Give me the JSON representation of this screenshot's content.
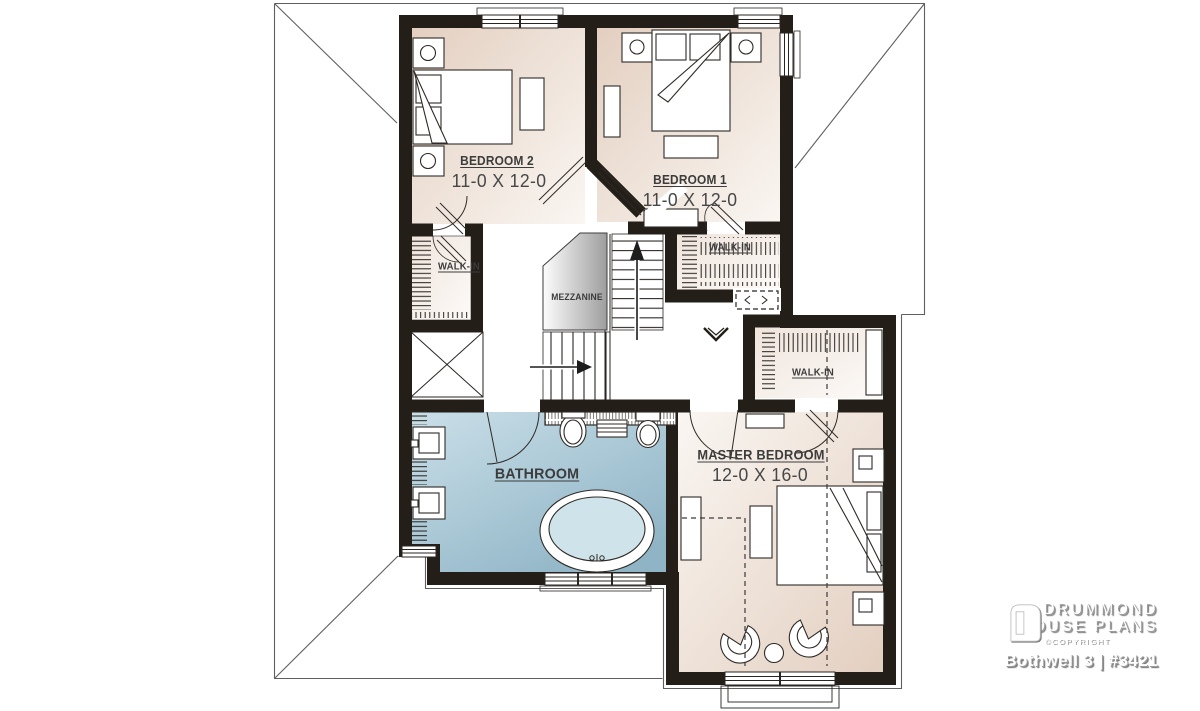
{
  "branding": {
    "name_line1": "DRUMMOND",
    "name_line2": "HOUSE PLANS",
    "copyright": "©COPYRIGHT",
    "plan_title": "Bothwell 3 | #3421",
    "logo_icon": "drummond-door-icon"
  },
  "rooms": {
    "bedroom2": {
      "name": "BEDROOM 2",
      "dims": "11-0 X 12-0"
    },
    "bedroom1": {
      "name": "BEDROOM 1",
      "dims": "11-0 X 12-0"
    },
    "walkin_bedroom2": {
      "name": "WALK-IN"
    },
    "walkin_bedroom1": {
      "name": "WALK-IN"
    },
    "walkin_master": {
      "name": "WALK-IN"
    },
    "mezzanine": {
      "name": "MEZZANINE"
    },
    "bathroom": {
      "name": "BATHROOM"
    },
    "master_bedroom": {
      "name": "MASTER BEDROOM",
      "dims": "12-0 X 16-0"
    }
  },
  "colors": {
    "wall": "#241e19",
    "room_beige_dark": "#e3cfc0",
    "room_beige_light": "#faf6f2",
    "bath_blue_dark": "#8fb4c6",
    "bath_blue_light": "#cadfe8",
    "mezzanine_dark": "#9e9e9e",
    "mezzanine_light": "#fdfdfd",
    "label_text": "#3c3c3c",
    "roof_line": "#5f5f5f"
  }
}
